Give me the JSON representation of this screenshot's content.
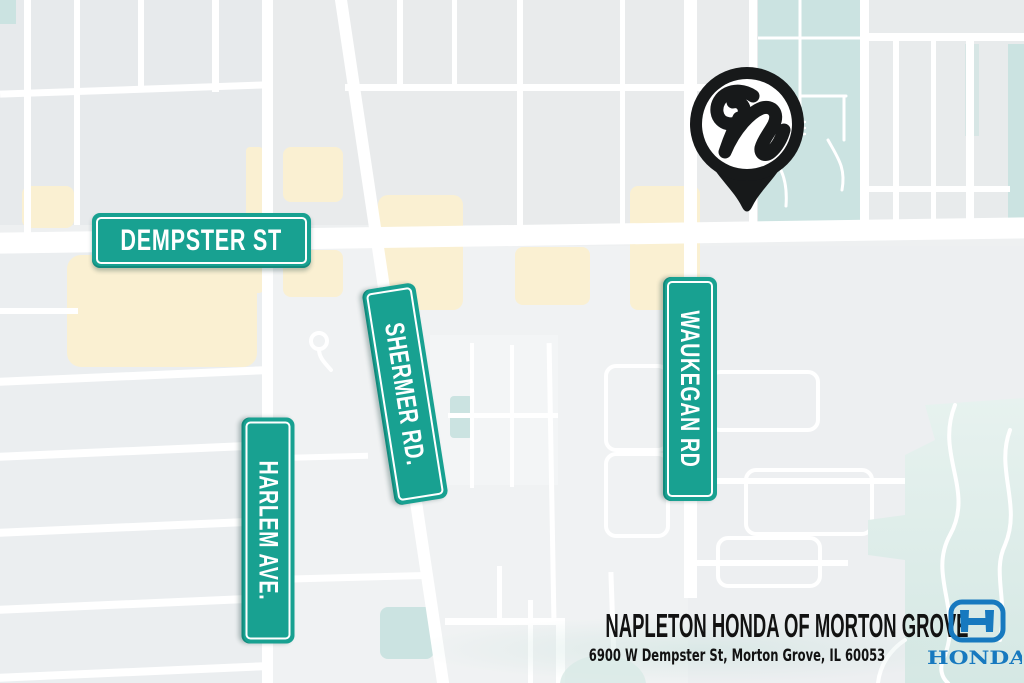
{
  "map": {
    "street_signs": [
      {
        "id": "dempster",
        "label": "DEMPSTER ST"
      },
      {
        "id": "shermer",
        "label": "SHERMER RD."
      },
      {
        "id": "harlem",
        "label": "HARLEM AVE."
      },
      {
        "id": "waukegan",
        "label": "WAUKEGAN RD"
      }
    ],
    "location_pin": {
      "monogram": "n"
    },
    "colors": {
      "sign_teal": "#18a191",
      "park_teal": "#cbe3e1",
      "preserve_pale_teal": "#d9eae6",
      "commercial_beige": "#faf0d2",
      "block_gray": "#eaedee",
      "street_white": "#ffffff",
      "pin_black": "#17191a",
      "honda_blue": "#1779bf",
      "text_black": "#121212"
    }
  },
  "footer": {
    "dealership_name": "NAPLETON HONDA OF MORTON GROVE",
    "address": "6900 W Dempster St, Morton Grove, IL 60053",
    "brand_wordmark": "HONDA"
  }
}
